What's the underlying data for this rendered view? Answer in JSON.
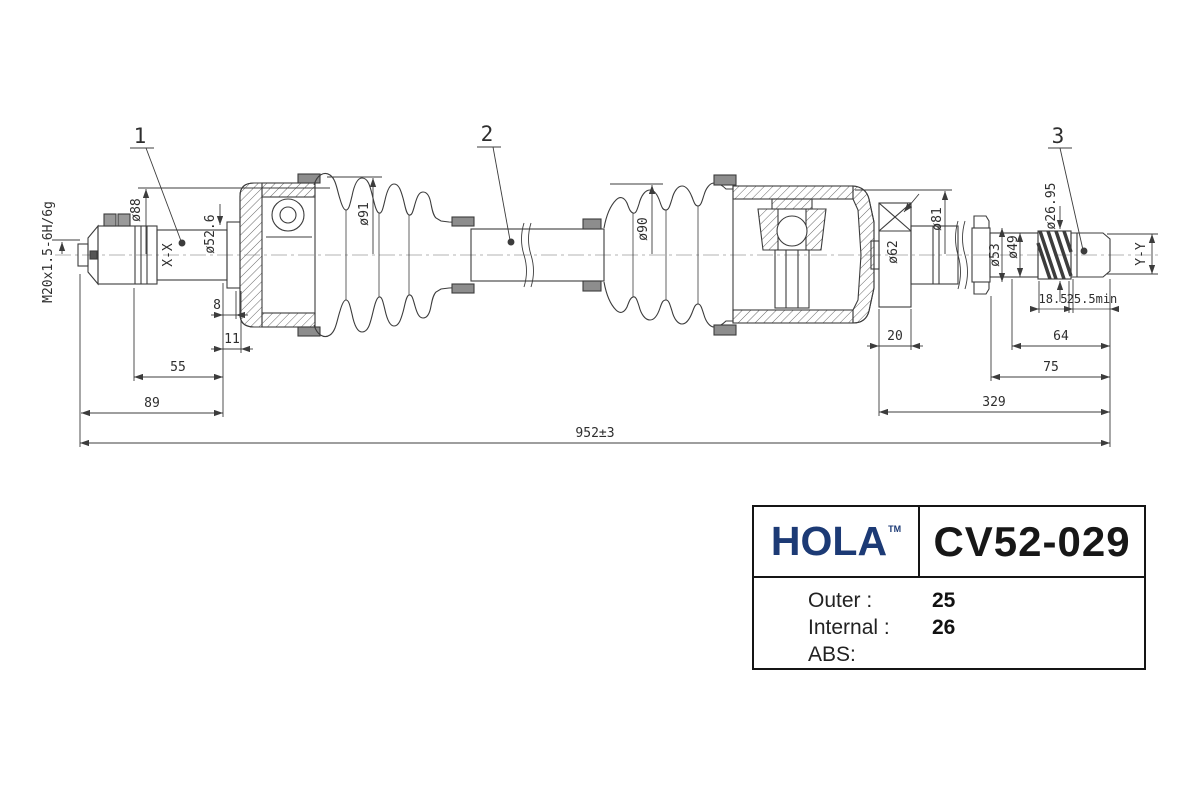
{
  "drawing": {
    "callout_1": "1",
    "callout_2": "2",
    "callout_3": "3",
    "thread_label": "M20x1.5-6H/6g",
    "section_left": "X-X",
    "section_right": "Y-Y",
    "dia_88": "ø88",
    "dia_52_6": "ø52.6",
    "dia_91": "ø91",
    "dia_90": "ø90",
    "dia_62": "ø62",
    "dia_81": "ø81",
    "dia_53": "ø53",
    "dia_49": "ø49",
    "dia_26_95": "ø26.95",
    "len_8": "8",
    "len_11": "11",
    "len_55": "55",
    "len_89": "89",
    "len_20": "20",
    "len_18_5": "18.5",
    "len_25_5_min": "25.5min",
    "len_64": "64",
    "len_75": "75",
    "len_329": "329",
    "len_total": "952±3"
  },
  "plate": {
    "brand": "HOLA",
    "trademark": "TM",
    "part_number": "CV52-029",
    "specs": [
      {
        "label": "Outer :",
        "value": "25"
      },
      {
        "label": "Internal :",
        "value": "26"
      },
      {
        "label": "ABS:",
        "value": ""
      }
    ],
    "colors": {
      "brand_blue": "#1c3a75",
      "line_color": "#3c3c3c"
    }
  }
}
